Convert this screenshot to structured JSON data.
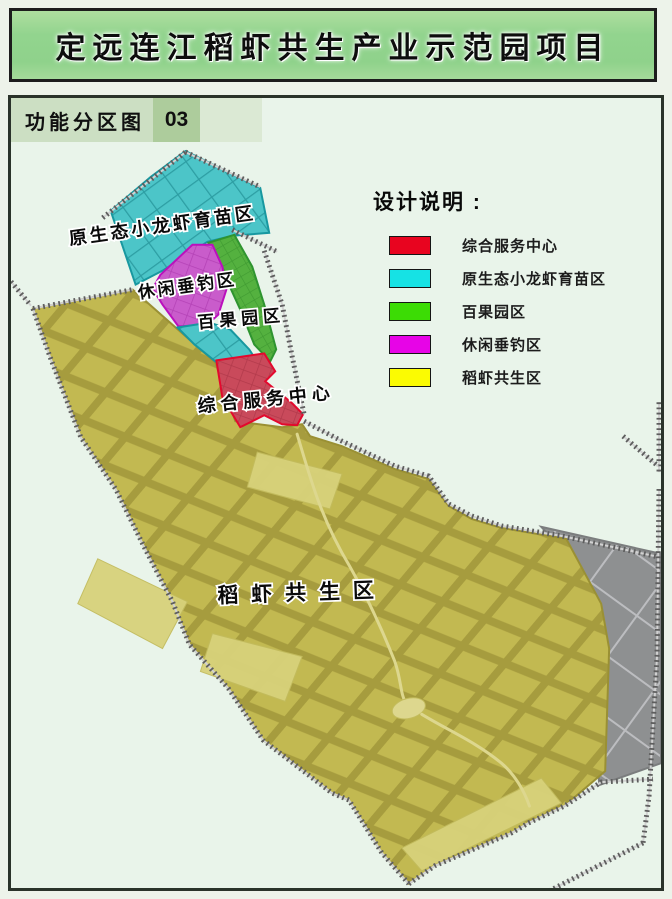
{
  "title": "定远连江稻虾共生产业示范园项目",
  "map_header": {
    "label": "功能分区图",
    "number": "03"
  },
  "legend": {
    "title": "设计说明 :",
    "items": [
      {
        "label": "综合服务中心",
        "color": "#e8041f"
      },
      {
        "label": "原生态小龙虾育苗区",
        "color": "#16e2e4"
      },
      {
        "label": "百果园区",
        "color": "#3cdc05"
      },
      {
        "label": "休闲垂钓区",
        "color": "#e704e7"
      },
      {
        "label": "稻虾共生区",
        "color": "#fbfb02"
      }
    ]
  },
  "map_labels": {
    "breeding": "原生态小龙虾育苗区",
    "fishing": "休闲垂钓区",
    "orchard": "百果园区",
    "service": "综合服务中心",
    "rice": "稻虾共生区"
  },
  "zone_colors": {
    "service_fill": "#c94a5b",
    "service_border": "#e3092d",
    "breeding_fill": "#4cc5c8",
    "breeding_border": "#1898a0",
    "orchard_fill": "#54b13f",
    "orchard_border": "#2f9430",
    "fishing_fill": "#c95ccb",
    "fishing_border": "#bb10bd",
    "rice_fill": "#c2b951",
    "rice_border": "#9a9034",
    "other_land_fill": "#8e9091",
    "other_land_border": "#7b7d7e",
    "background": "#e9f4ea"
  }
}
